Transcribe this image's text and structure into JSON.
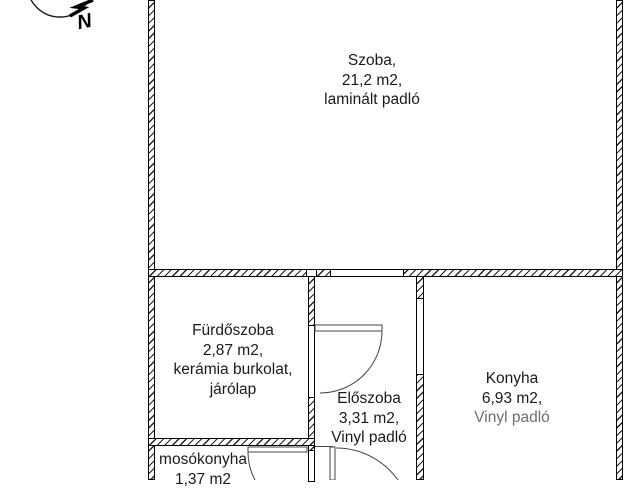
{
  "plan": {
    "compass": {
      "north_label": "N"
    },
    "rooms": {
      "szoba": {
        "name": "Szoba,",
        "area": "21,2 m2,",
        "floor": "laminált padló"
      },
      "furdoszoba": {
        "name": "Fürdőszoba",
        "area": "2,87 m2,",
        "floor_line1": "kerámia burkolat,",
        "floor_line2": "járólap"
      },
      "eloszoba": {
        "name": "Előszoba",
        "area": "3,31 m2,",
        "floor": "Vinyl padló"
      },
      "konyha": {
        "name": "Konyha",
        "area": "6,93 m2,",
        "floor": "Vinyl padló"
      },
      "mosokonyha": {
        "name": "mosókonyha",
        "area": "1,37 m2"
      }
    },
    "colors": {
      "line": "#1a1a1a",
      "background": "#ffffff",
      "faded_text": "#6f6f6f"
    }
  }
}
